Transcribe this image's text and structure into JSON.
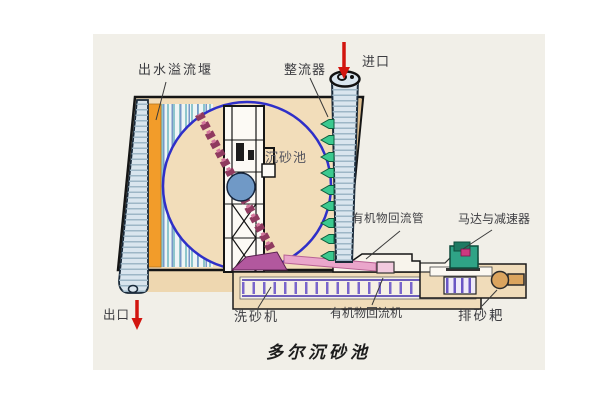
{
  "figure": {
    "title": "多尔沉砂池",
    "labels": {
      "outlet_weir": "出水溢流堰",
      "flow_rectifier": "整流器",
      "inlet": "进口",
      "grit_chamber": "沉砂池",
      "organic_return_pipe": "有机物回流管",
      "motor_and_reducer": "马达与减速器",
      "outlet": "出口",
      "sand_washer": "洗砂机",
      "organic_return_machine": "有机物回流机",
      "grit_rake": "排砂耙"
    },
    "icons": {
      "inlet_arrow": "red-down-arrow",
      "outlet_arrow": "red-down-arrow",
      "flow_arrows": "green-left-arrows"
    },
    "colors": {
      "canvas": "#f1efe8",
      "tank_fill": "#f2ddba",
      "weir_orange": "#f29c2a",
      "circle_outline": "#2f2fc8",
      "arrow_red": "#d2150f",
      "flow_arrow_green": "#3bc98f",
      "motor_teal": "#2fa386",
      "pipe_pink": "#eaa6cb",
      "rail_purple": "#5a48b4",
      "channel_blue": "#d9e5ee",
      "chain_magenta": "#8f3a5f"
    }
  }
}
